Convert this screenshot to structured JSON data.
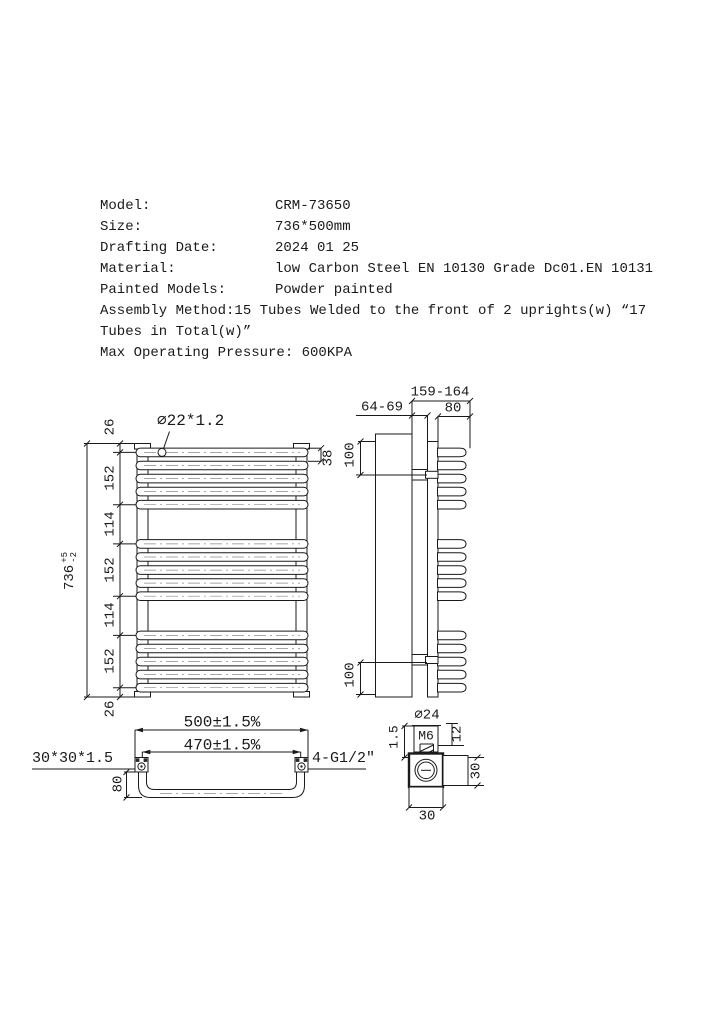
{
  "specs": {
    "rows": [
      {
        "label": "Model:",
        "value": "CRM-73650"
      },
      {
        "label": "Size:",
        "value": "736*500mm"
      },
      {
        "label": "Drafting Date:",
        "value": "2024 01 25"
      },
      {
        "label": "Material:",
        "value": "low Carbon Steel EN 10130 Grade Dc01.EN 10131"
      },
      {
        "label": "Painted Models:",
        "value": "Powder painted"
      }
    ],
    "assembly_line1": "Assembly Method:15 Tubes Welded to the front of 2 uprights(w) “17",
    "assembly_line2": "Tubes in Total(w)”",
    "max_pressure": "Max Operating Pressure: 600KPA"
  },
  "front_view": {
    "tube_spec": "∅22*1.2",
    "tube_pitch": "38",
    "overall_height": "736",
    "height_tol_plus": "+5",
    "height_tol_minus": "-2",
    "chain": [
      "26",
      "152",
      "114",
      "152",
      "114",
      "152",
      "26"
    ]
  },
  "side_view": {
    "overall_depth": "159-164",
    "wall_distance": "64-69",
    "tube_depth": "80",
    "bracket_top_offset": "100",
    "bracket_bottom_offset": "100"
  },
  "bottom_view": {
    "overall_width": "500±1.5%",
    "port_centers": "470±1.5%",
    "upright_section": "30*30*1.5",
    "connections": "4-G1/2″",
    "depth": "80"
  },
  "detail_view": {
    "diameter": "∅24",
    "thread": "M6",
    "step": "1.5",
    "boss_height": "12",
    "side": "30",
    "width": "30"
  },
  "colors": {
    "line": "#1a1a1a",
    "background": "#ffffff"
  }
}
